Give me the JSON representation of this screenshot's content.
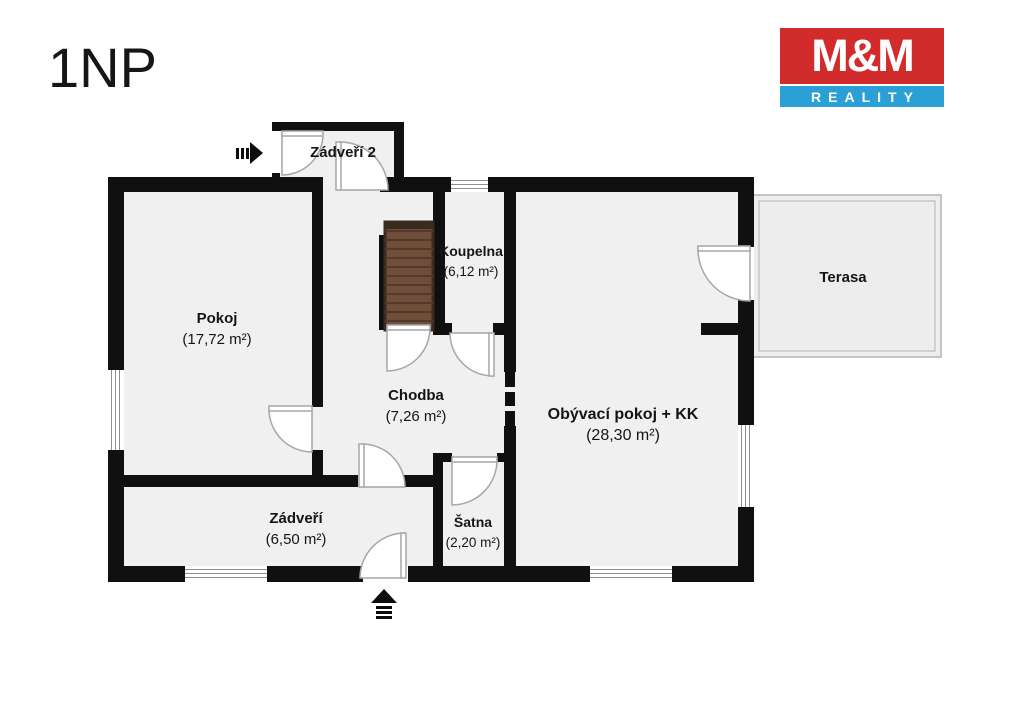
{
  "page": {
    "title": "1NP"
  },
  "logo": {
    "brand_top": "M&M",
    "brand_bottom": "REALITY",
    "red": "#d22b2b",
    "blue": "#2ba0d6"
  },
  "rooms": {
    "zadveri2": {
      "name": "Zádveří 2",
      "area": ""
    },
    "pokoj": {
      "name": "Pokoj",
      "area": "(17,72 m²)"
    },
    "koupelna": {
      "name": "Koupelna",
      "area": "(6,12 m²)"
    },
    "chodba": {
      "name": "Chodba",
      "area": "(7,26 m²)"
    },
    "obyvaci_pokoj": {
      "name": "Obývací pokoj + KK",
      "area": "(28,30 m²)"
    },
    "terasa": {
      "name": "Terasa",
      "area": ""
    },
    "zadveri": {
      "name": "Zádveří",
      "area": "(6,50 m²)"
    },
    "satna": {
      "name": "Šatna",
      "area": "(2,20 m²)"
    }
  },
  "icons": {
    "main_entrance_arrow": "arrow-up-entrance",
    "side_entrance_arrow": "arrow-right-entrance",
    "staircase": "stairs"
  },
  "colors": {
    "wall": "#101010",
    "floor": "#f0f0f0",
    "terrace_floor": "#ededed",
    "terrace_border": "#b3b3b3",
    "stairs_fill": "#6f4e3a",
    "stairs_line": "#53392b",
    "door_arc": "#a6a6a6",
    "window_line": "#8f8f8f",
    "text": "#161616"
  }
}
